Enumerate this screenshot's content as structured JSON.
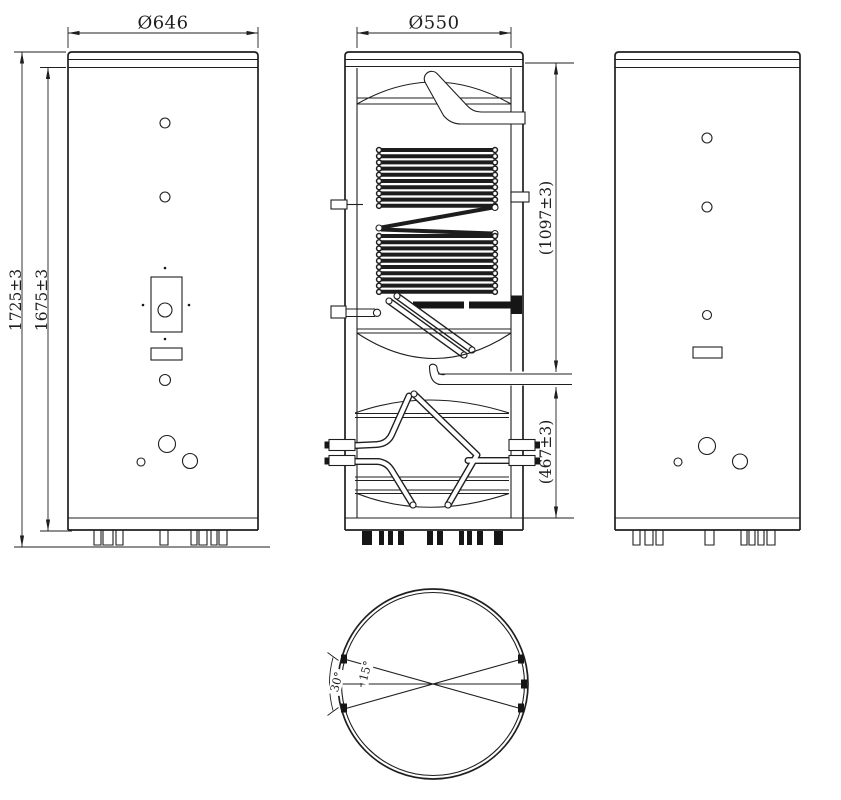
{
  "front_view": {
    "diameter_label": "Ø646",
    "height_overall_label": "1725±3",
    "height_body_label": "1675±3"
  },
  "section_view": {
    "diameter_label": "Ø550",
    "upper_section_label": "(1097±3)",
    "lower_section_label": "(467±3)"
  },
  "bottom_view": {
    "angle_span_label": "30°",
    "angle_half_label": "15°"
  },
  "colors": {
    "line": "#1f1f1f",
    "background": "#ffffff"
  }
}
